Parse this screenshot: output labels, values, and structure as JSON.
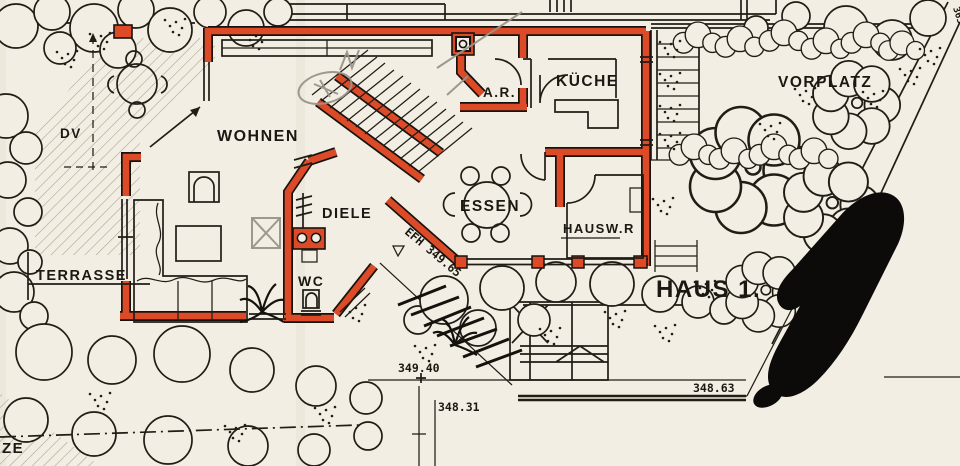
{
  "document": {
    "type": "architectural-site-and-floor-plan",
    "building_label": "HAUS 1."
  },
  "colors": {
    "paper": "#f2eee3",
    "ink": "#201d17",
    "wall_red": "#dc4a28",
    "pencil": "#98948a"
  },
  "rooms": {
    "wohnen": "WOHNEN",
    "diele": "DIELE",
    "wc": "WC",
    "abstellraum": "A.R.",
    "kueche": "KÜCHE",
    "essen": "ESSEN",
    "hauswirtschaftsraum": "HAUSW.R"
  },
  "outdoor": {
    "terrasse": "TERRASSE",
    "vorplatz": "VORPLATZ",
    "dv": "DV",
    "ze": "ZE",
    "parcel": "363"
  },
  "annotations": {
    "haus": "HAUS 1.",
    "efh_level": "EFH 349.65",
    "elev_349_40": "349.40",
    "elev_348_31": "348.31",
    "elev_348_63": "348.63"
  }
}
